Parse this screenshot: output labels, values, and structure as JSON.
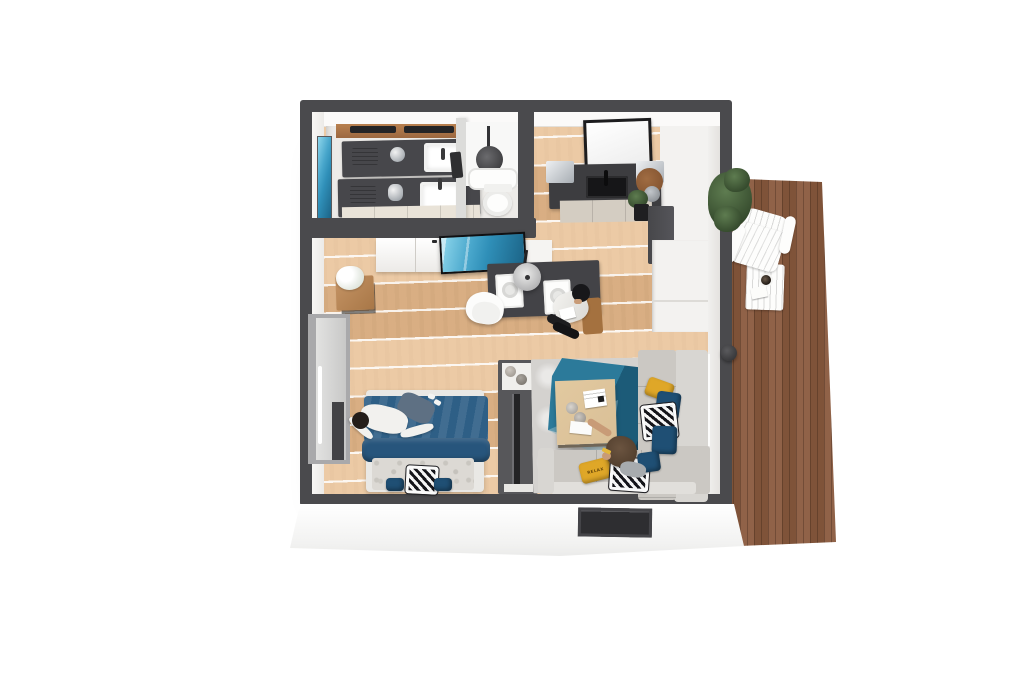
{
  "title": "3D isometric floor plan render of a studio apartment with deck",
  "colors": {
    "bg": "#ffffff",
    "wall": "#4a4a4d",
    "white": "#f4f3f1",
    "floorWood": "#e2b98d",
    "deckWood": "#8a5a3e",
    "bathFloor": "#edebe8",
    "counterDark": "#47474b",
    "cabinetCream": "#e9e3d8",
    "bedBlue": "#2e5f86",
    "bedBlueDark": "#27557c",
    "pillowBlue": "#1f4f74",
    "pillowYellow": "#dfa728",
    "couchGray": "#cbc8c3",
    "couchLight": "#d8d6d2",
    "rugGray": "#d4d2cf",
    "rugTeal": "#2c7a9a",
    "rugTealDark": "#12435c",
    "tableWood": "#d9bf96",
    "oceanBlue": "#2f8fb8",
    "skin": "#c89b77"
  },
  "rooms": {
    "bathroom": {
      "label": "Bathroom",
      "items": [
        "double vanity with two sinks",
        "metal appliances",
        "wall artwork",
        "shower with rain head",
        "toilet"
      ]
    },
    "kitchen": {
      "label": "Kitchen",
      "items": [
        "framed window",
        "dark countertop with sink",
        "stainless worktops",
        "cream cabinets",
        "round wooden board",
        "potted plant",
        "tall cabinet"
      ]
    },
    "living_dining": {
      "label": "Living / Dining",
      "items": [
        "wall TV with ocean scene",
        "white double doors",
        "white sideboard",
        "dark dining table with two place settings",
        "pendant lamp",
        "white shell chair",
        "side table with white flowers"
      ]
    },
    "bedroom": {
      "label": "Bedroom",
      "items": [
        "double bed with blue duvet",
        "marble headboard bench",
        "wardrobe with mirror",
        "media console with TV"
      ]
    },
    "lounge": {
      "label": "Lounge",
      "items": [
        "L-shaped grey sectional sofa",
        "wooden coffee table",
        "grey rug",
        "teal geometric rug",
        "decor pillows"
      ]
    },
    "deck": {
      "label": "Deck",
      "items": [
        "white adirondack chair",
        "white slat side table",
        "coffee cup",
        "magazine",
        "green bush",
        "door handle"
      ]
    }
  },
  "people": [
    {
      "location": "bed",
      "pose": "lying down, arms spread"
    },
    {
      "location": "dining chair",
      "pose": "sitting, reading papers, black beanie"
    },
    {
      "location": "sofa",
      "pose": "sitting, brown hair, yellow sunglasses"
    }
  ],
  "text": {
    "pillow": "RELAX"
  }
}
